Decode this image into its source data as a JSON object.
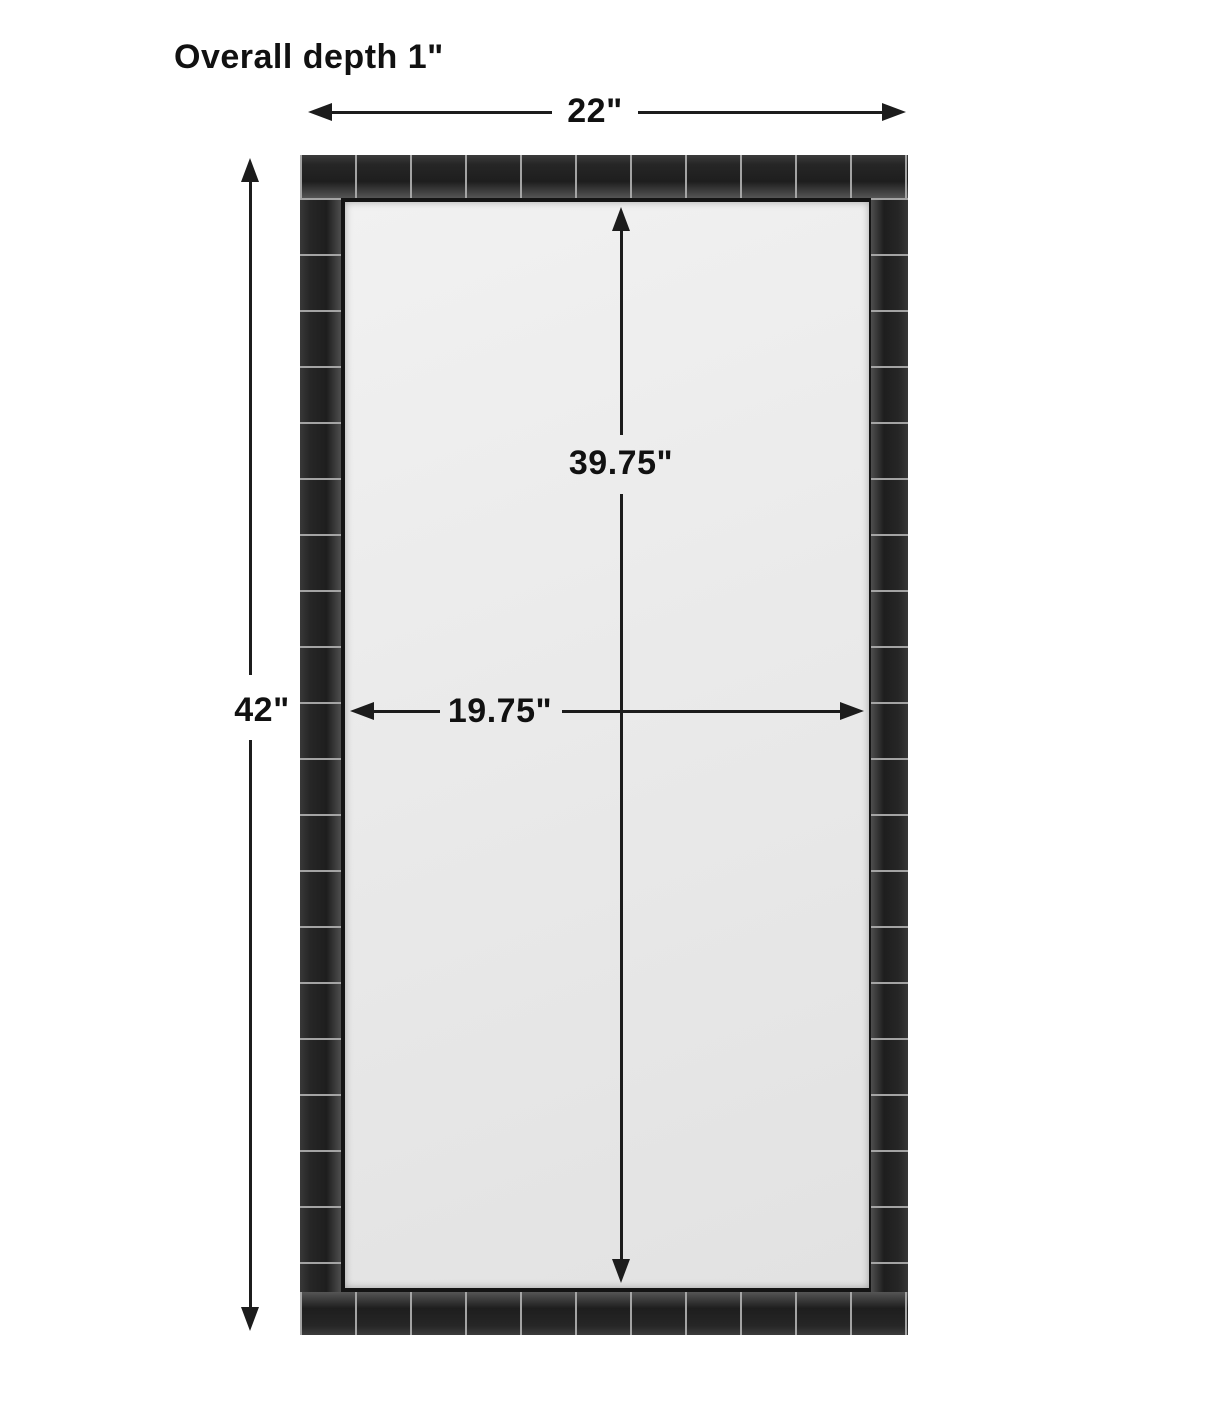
{
  "diagram": {
    "title": "Overall depth 1\"",
    "overall_width_label": "22\"",
    "overall_height_label": "42\"",
    "inner_height_label": "39.75\"",
    "inner_width_label": "19.75\""
  },
  "colors": {
    "background": "#ffffff",
    "dimension_line": "#1c1c1c",
    "frame_tile": "#242424",
    "frame_grout": "#aaaaaa",
    "glass": "#e9e9e9"
  }
}
